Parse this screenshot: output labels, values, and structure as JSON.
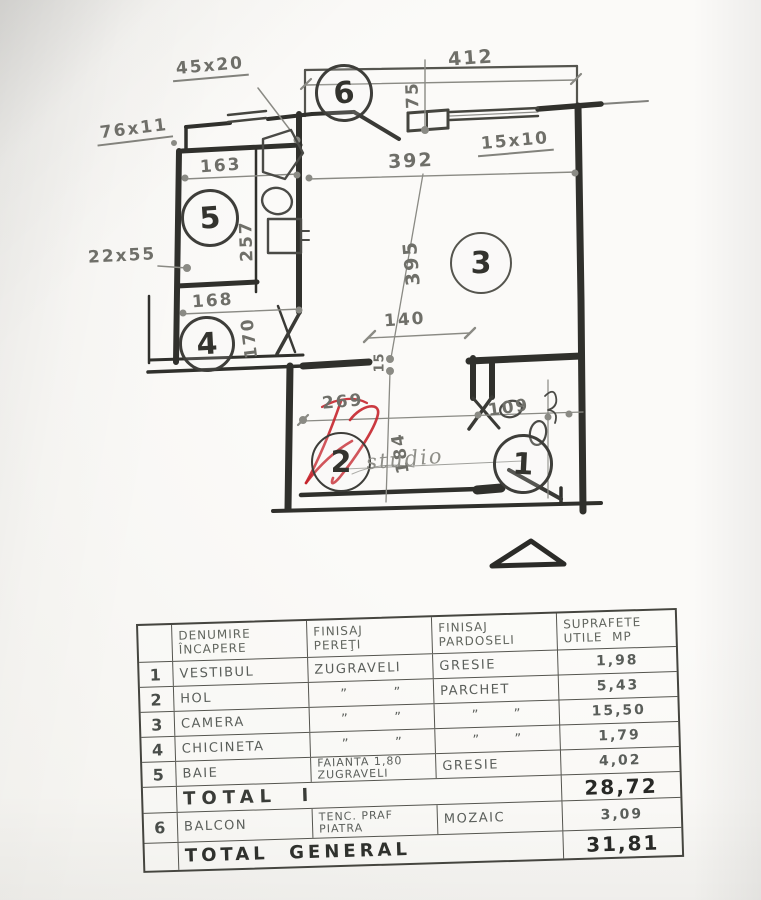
{
  "plan": {
    "room_labels": [
      "1",
      "2",
      "3",
      "4",
      "5",
      "6"
    ],
    "dims": {
      "beam_45x20": "45x20",
      "balcony_width": "412",
      "balcony_depth": "75",
      "beam_76x11": "76x11",
      "bath_width": "163",
      "camera_width": "392",
      "win_15x10": "15x10",
      "bath_height": "257",
      "col_22x55": "22x55",
      "camera_height": "395",
      "kitch_width": "168",
      "kitch_height": "170",
      "opening_width": "140",
      "wall_thickness": "15",
      "hol_width": "269",
      "hol_height": "184",
      "vestibul_width": "109"
    },
    "watermark_text": "studio",
    "colors": {
      "watermark_red": "#c5242b",
      "ink": "#30302c",
      "pencil": "#8a8a84"
    }
  },
  "table": {
    "headers": {
      "name_l1": "DENUMIRE",
      "name_l2": "ÎNCAPERE",
      "pereti_l1": "FINISAJ",
      "pereti_l2": "PEREŢI",
      "pardoseli_l1": "FINISAJ",
      "pardoseli_l2": "PARDOSELI",
      "mp_l1": "SUPRAFETE",
      "mp_l2": "UTILE  MP"
    },
    "rows": [
      {
        "no": "1",
        "name": "VESTIBUL",
        "pereti1": "ZUGRAVELI",
        "pereti2": "",
        "pardoseli": "GRESIE",
        "mp": "1,98"
      },
      {
        "no": "2",
        "name": "HOL",
        "pereti1": "”        ”",
        "pereti2": "",
        "pardoseli": "PARCHET",
        "mp": "5,43"
      },
      {
        "no": "3",
        "name": "CAMERA",
        "pereti1": "”        ”",
        "pereti2": "",
        "pardoseli": "”      ”",
        "mp": "15,50"
      },
      {
        "no": "4",
        "name": "CHICINETA",
        "pereti1": "”        ”",
        "pereti2": "",
        "pardoseli": "”      ”",
        "mp": "1,79"
      },
      {
        "no": "5",
        "name": "BAIE",
        "pereti1": "FAIANTA 1,80",
        "pereti2": "ZUGRAVELI",
        "pardoseli": "GRESIE",
        "mp": "4,02"
      },
      {
        "no": "6",
        "name": "BALCON",
        "pereti1": "TENC. PRAF",
        "pereti2": "PIATRA",
        "pardoseli": "MOZAIC",
        "mp": "3,09"
      }
    ],
    "total1": {
      "label": "TOTAL  I",
      "value": "28,72"
    },
    "total_general": {
      "label": "TOTAL  GENERAL",
      "value": "31,81"
    }
  }
}
